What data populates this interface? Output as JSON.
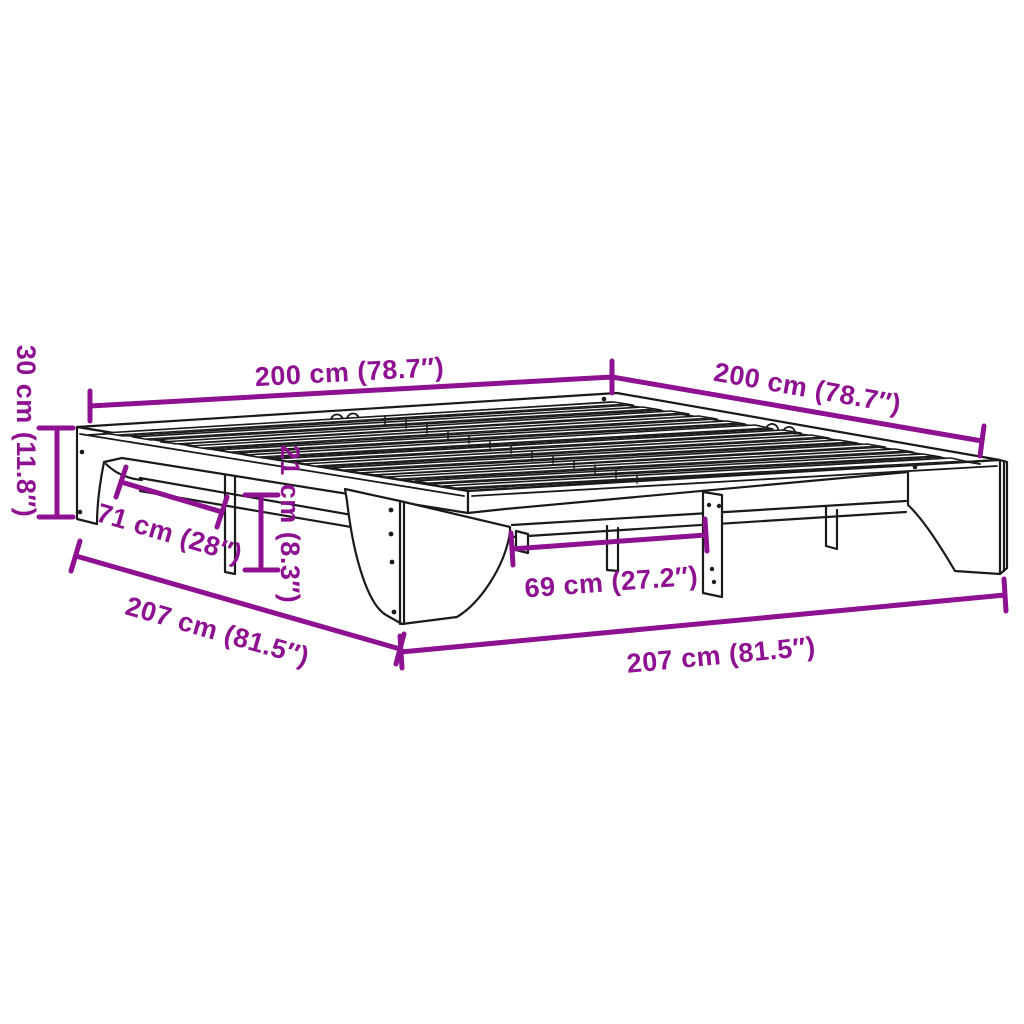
{
  "diagram": {
    "subject": "isometric line drawing of a wooden slatted bed frame without headboard",
    "accent_color": "#8E1191",
    "drawing_color": "#1A1A1A",
    "background_color": "#FFFFFF",
    "dimensions": [
      {
        "id": "width-top-left",
        "label": "200 cm (78.7″)"
      },
      {
        "id": "width-top-right",
        "label": "200 cm (78.7″)"
      },
      {
        "id": "height-left",
        "label": "30 cm (11.8″)"
      },
      {
        "id": "leg-span-left",
        "label": "71 cm (28″)"
      },
      {
        "id": "floor-clearance",
        "label": "21 cm (8.3″)"
      },
      {
        "id": "leg-span-right",
        "label": "69 cm (27.2″)"
      },
      {
        "id": "length-bottom-left",
        "label": "207 cm (81.5″)"
      },
      {
        "id": "length-bottom-right",
        "label": "207 cm (81.5″)"
      }
    ]
  }
}
